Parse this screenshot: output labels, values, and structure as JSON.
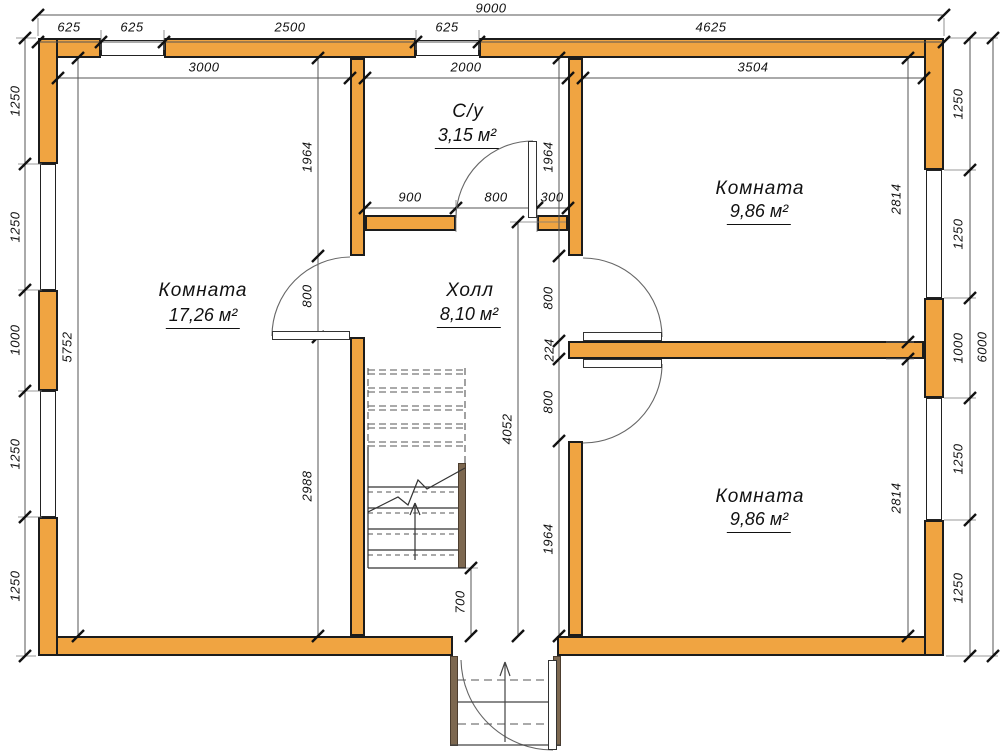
{
  "drawing": {
    "type": "floor-plan",
    "units": "mm",
    "wall_fill_color": "#f0a441",
    "wall_outline_color": "#1c1c1c",
    "timber_color": "#7d6850"
  },
  "rooms": {
    "left": {
      "name": "Комната",
      "area": "17,26 м²"
    },
    "hall": {
      "name": "Холл",
      "area": "8,10 м²"
    },
    "bathroom": {
      "name": "С/у",
      "area": "3,15 м²"
    },
    "top_right": {
      "name": "Комната",
      "area": "9,86 м²"
    },
    "bottom_right": {
      "name": "Комната",
      "area": "9,86 м²"
    }
  },
  "dims": {
    "total_w": "9000",
    "total_h": "6000",
    "top": [
      "625",
      "625",
      "2500",
      "625",
      "4625"
    ],
    "top_inner": [
      "3000",
      "2000",
      "3504"
    ],
    "left": [
      "1250",
      "1250",
      "1000",
      "1250",
      "1250"
    ],
    "left_inner": "5752",
    "right": [
      "1250",
      "1250",
      "1000",
      "1250",
      "1250"
    ],
    "rooms_r": [
      "2814",
      "2814"
    ],
    "lpart": [
      "1964",
      "800",
      "2988"
    ],
    "rpart": [
      "1964",
      "800",
      "224",
      "800",
      "1964"
    ],
    "bath": [
      "900",
      "800",
      "300"
    ],
    "hall": "4052",
    "stair": "700"
  }
}
